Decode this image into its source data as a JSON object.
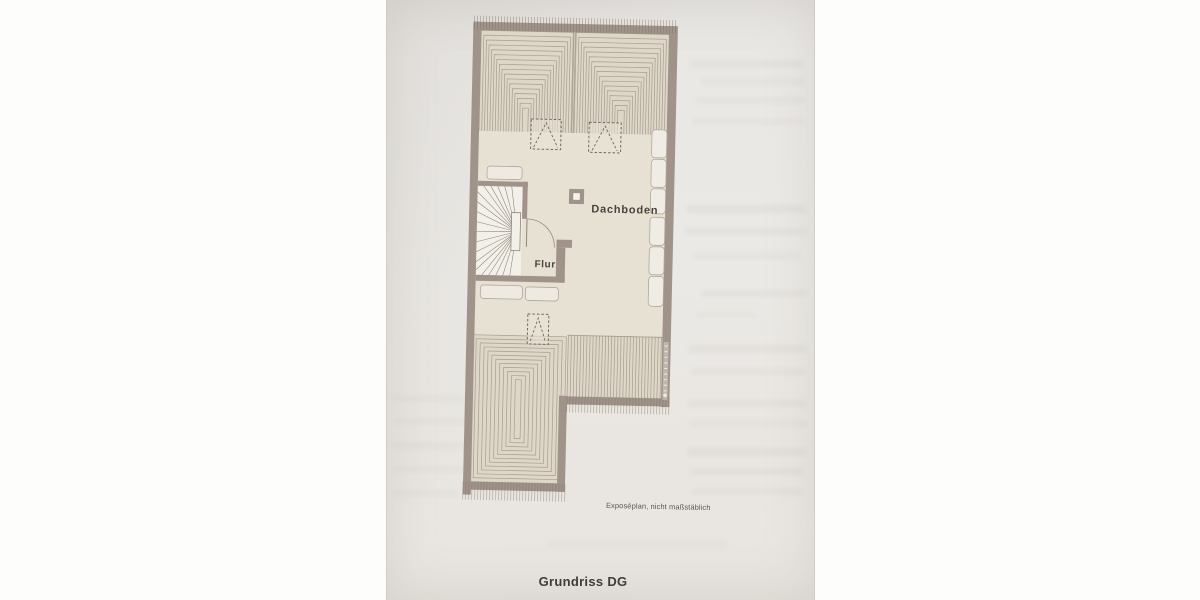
{
  "photo": {
    "caption": "Grundriss DG",
    "note": "Exposéplan, nicht maßstäblich"
  },
  "plan": {
    "rooms": [
      {
        "label": "Dachboden"
      },
      {
        "label": "Flur"
      }
    ],
    "symbols": {
      "skylights_dashed": 3,
      "winder_staircase": 1,
      "chimney": 1,
      "knee_wall_closets": 6
    },
    "colors": {
      "wall": "#a0948a",
      "floor": "#e7e1d3",
      "hatch_base": "#ded7c8",
      "hatch_line": "#a69c8f",
      "stair_fill": "#f3f0e9",
      "paper": "#e9e7e4",
      "label_text": "#4a443e"
    }
  }
}
